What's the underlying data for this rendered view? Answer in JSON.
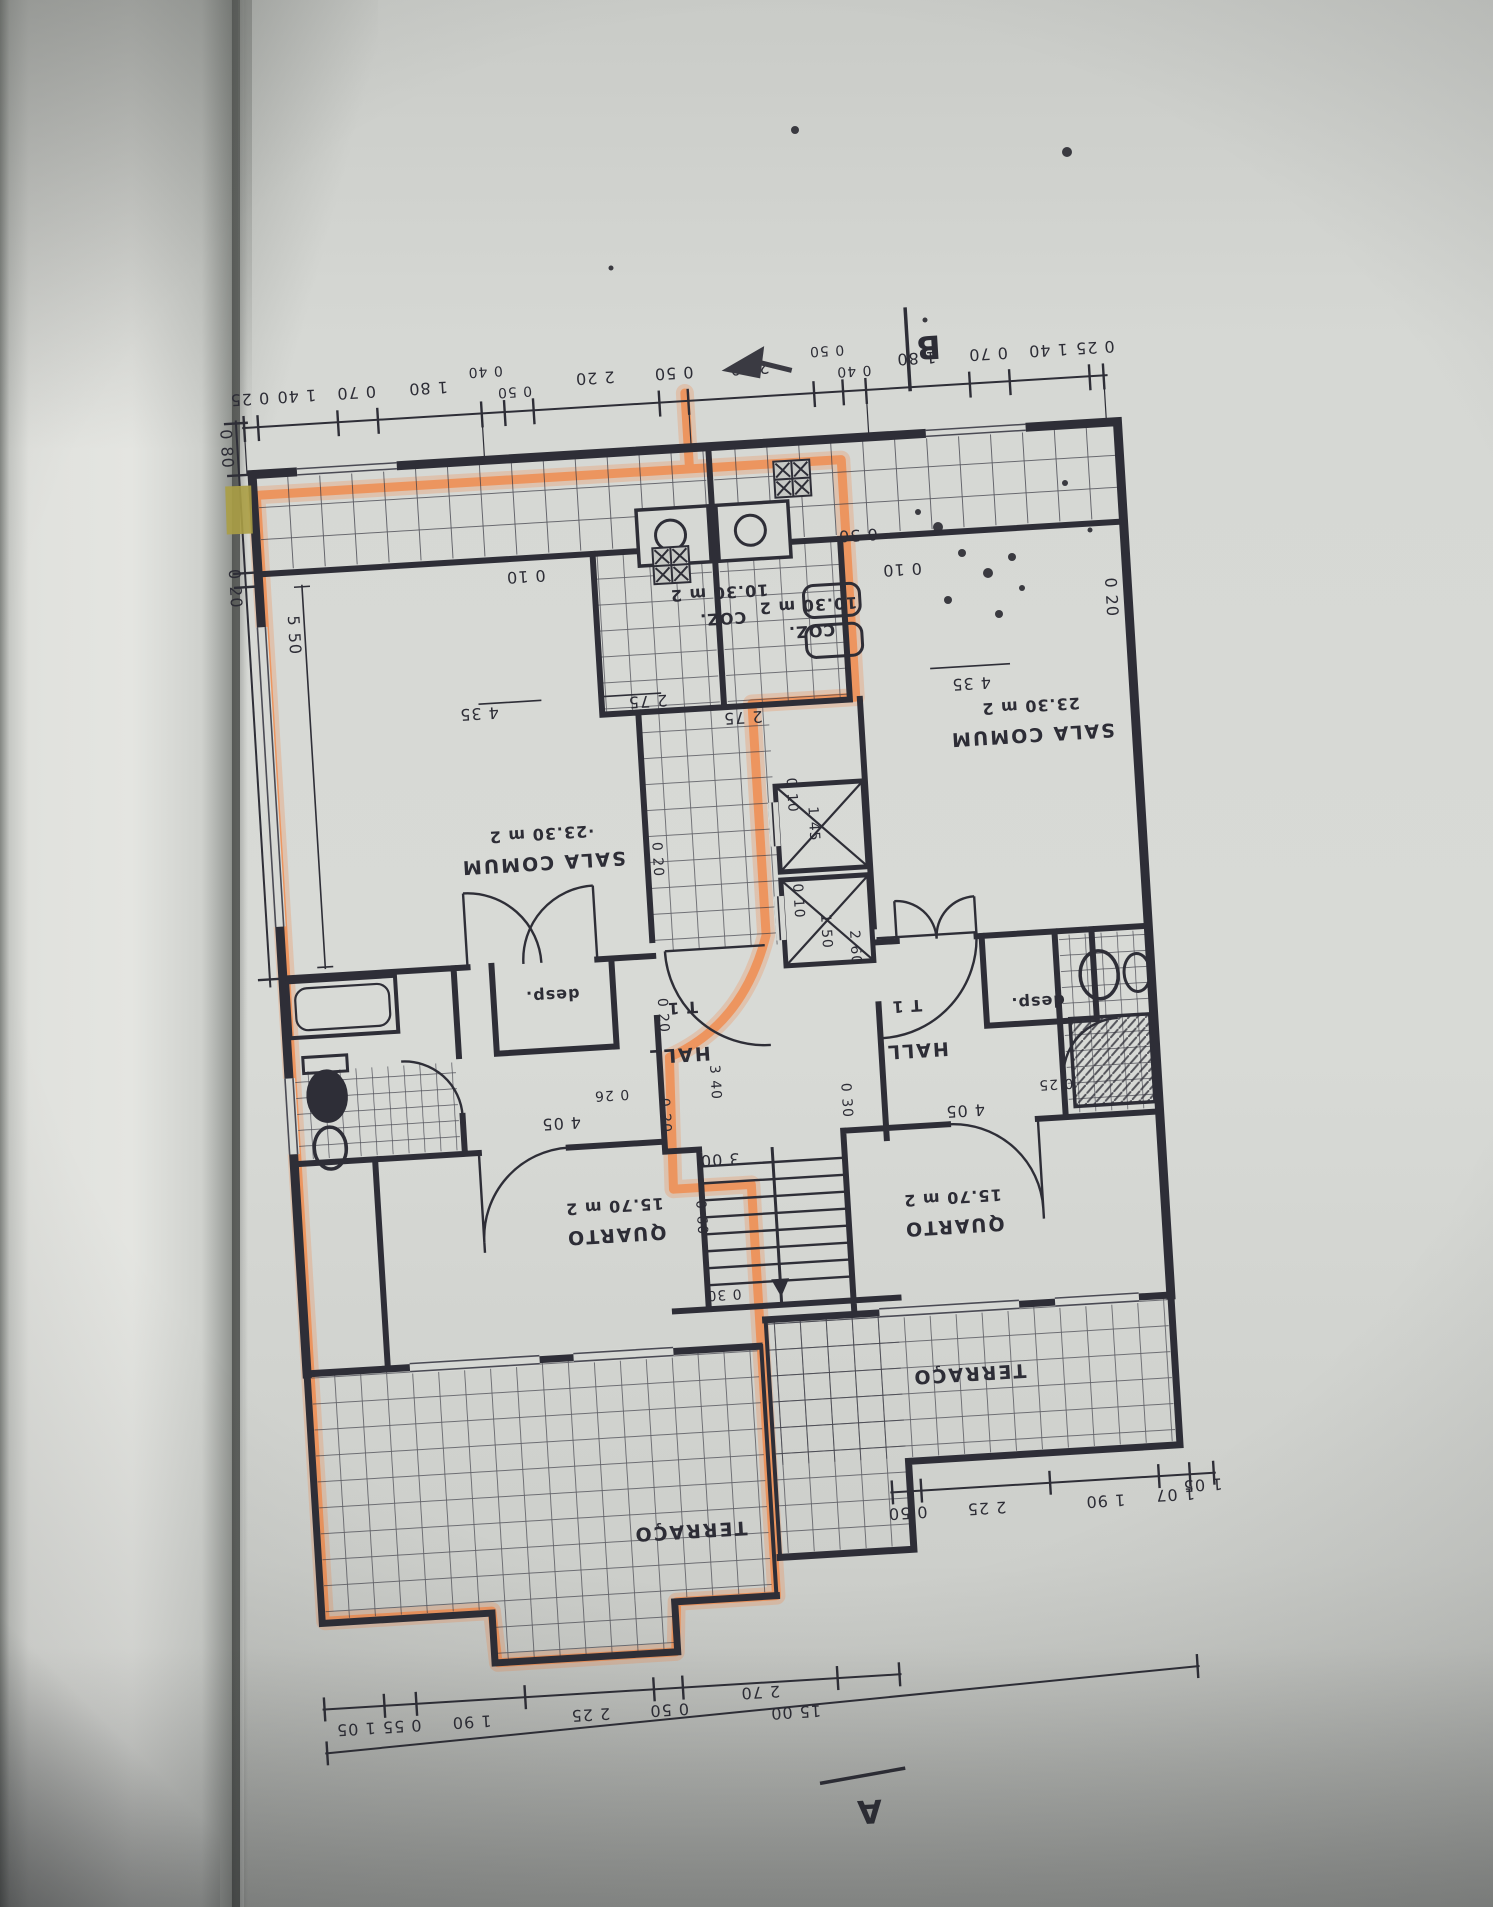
{
  "palette": {
    "paper": "#d6d8d4",
    "ink": "#2d2d36",
    "highlight_orange": "#f08a4b",
    "sticky_tab": "#ab9e45"
  },
  "markers": {
    "section_a": "A",
    "section_b": "B"
  },
  "apartment_left": {
    "sala_area": "·23.30 m 2",
    "sala": "SALA COMUM",
    "coz_area": "10.30 m 2",
    "coz": "COZ.",
    "type": "T 1",
    "hall": "HALL",
    "desp": "desp.",
    "quarto_area": "15.70 m 2",
    "quarto": "QUARTO",
    "terraco": "TERRAÇO"
  },
  "apartment_right": {
    "sala_area": "23.30 m 2",
    "sala": "SALA COMUM",
    "coz_area": "10.30 m 2",
    "coz": "COZ.",
    "type": "T 1",
    "hall": "HALL",
    "desp": "desp.",
    "quarto_area": "15.70 m 2",
    "quarto": "QUARTO",
    "terraco": "TERRAÇO"
  },
  "dims": {
    "top_chain": [
      "0 25",
      "1 40",
      "0 70",
      "1 80",
      "0 40",
      "0 50",
      "2 20",
      "0 50",
      "2 20",
      "0 50",
      "0 40",
      "1 80",
      "0 70",
      "1 40",
      "0 25"
    ],
    "bottom_chain_left": [
      "1 05",
      "0 55",
      "1 90",
      "2 25",
      "0 50",
      "2 70"
    ],
    "bottom_chain_right": [
      "0 50",
      "2 25",
      "1 90",
      "1 07",
      "1 05"
    ],
    "bottom_total": "15 00",
    "left_side": [
      "0 80",
      "0 20",
      "5 50"
    ],
    "right_side": [
      "0 30",
      "0 20"
    ],
    "sala_width": "4 35",
    "sala_depth": "0 10",
    "coz_width": "2 75",
    "quarto_width": "4 05",
    "quarto_off_left": "0 26",
    "quarto_off_right": "0 25",
    "wall_030": "0 30",
    "lift_010": "0 10",
    "lift_145": "1 45",
    "lift_150": "1 50",
    "hall_260": "2 60",
    "wall_020": "0 20",
    "stair_340": "3 40",
    "stair_300": "3 00",
    "stair_060": "0 60"
  }
}
